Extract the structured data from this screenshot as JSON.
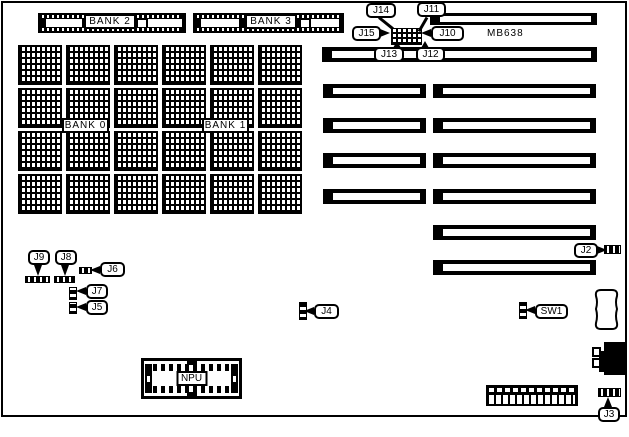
{
  "diagram": {
    "model": "MB638",
    "banks": {
      "bank0": "BANK 0",
      "bank1": "BANK 1",
      "bank2": "BANK 2",
      "bank3": "BANK 3"
    },
    "npu": "NPU",
    "callouts": {
      "j14": "J14",
      "j11": "J11",
      "j15": "J15",
      "j10": "J10",
      "j13": "J13",
      "j12": "J12",
      "j9": "J9",
      "j8": "J8",
      "j6": "J6",
      "j7": "J7",
      "j5": "J5",
      "j4": "J4",
      "j2": "J2",
      "sw1": "SW1",
      "j3": "J3"
    },
    "colors": {
      "line": "#000000",
      "background": "#ffffff"
    }
  }
}
